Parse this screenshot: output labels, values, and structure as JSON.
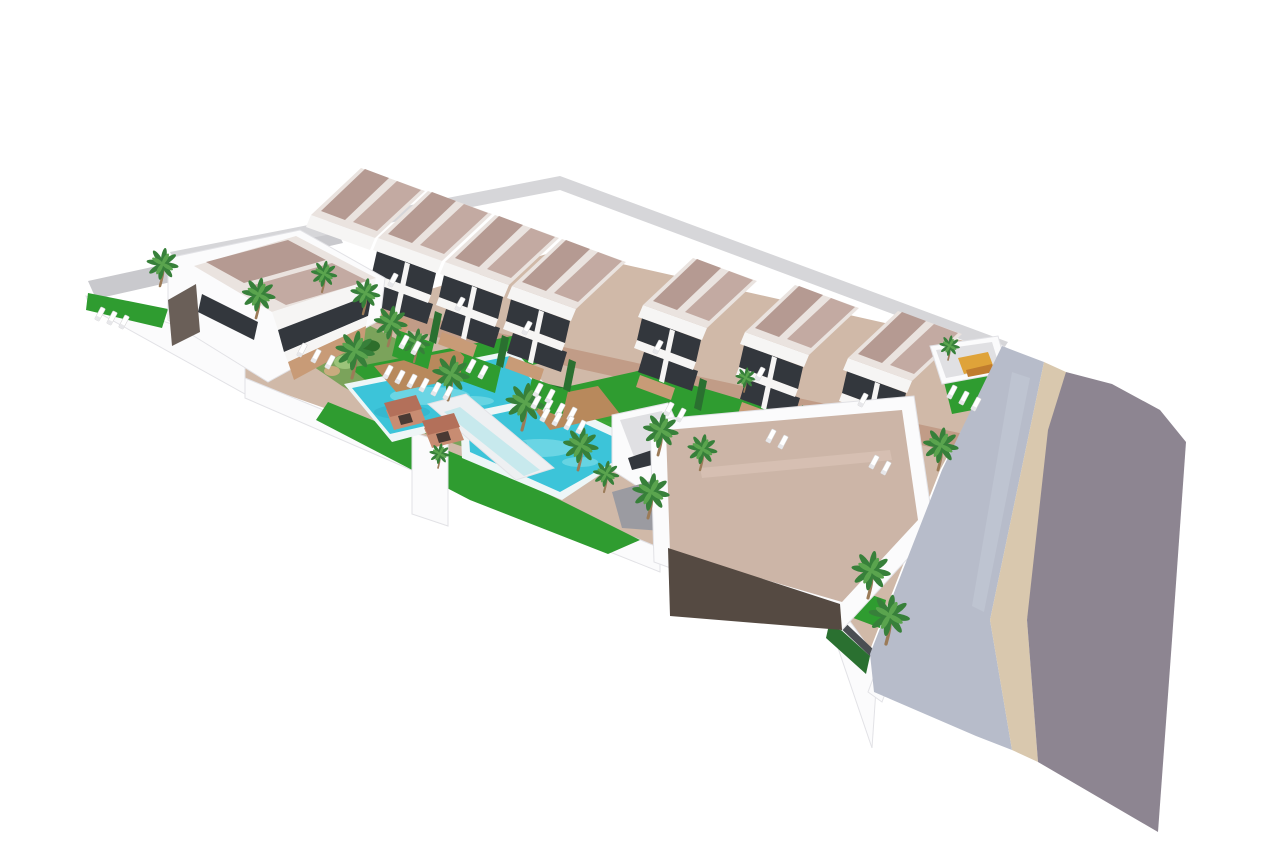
{
  "meta": {
    "description": "Aerial 3D architectural render of a white residential development: two terraces of duplex villas with mauve roofs, communal turquoise pools, lawns, palm trees, a flat-roofed clubhouse and a curving grey street with pale sidewalk on the right."
  },
  "palette": {
    "bg": "#ffffff",
    "roadLeft": "#c9c9cd",
    "padDark": "#63636a",
    "car": "#eef0f3",
    "alley": "#d6d6d9",
    "paving": "#d0b9a8",
    "brick": "#c19c87",
    "wallWhite": "#fbfbfc",
    "wallEdge": "#e2e2e6",
    "bedGreen": "#7ba35b",
    "bushDark": "#2d6e2b",
    "bushLight": "#9cc47a",
    "rock": "#c9ab7e",
    "lawn": "#2f9c30",
    "lawnLight": "#46b13c",
    "hedge": "#2a7030",
    "rim": "#eef6f7",
    "water": "#3cc4d9",
    "waterLight": "#8fe4ec",
    "waterDark": "#27a4bd",
    "bridge": "#eef0f2",
    "glassTeal": "#aee4ea",
    "wood": "#b8895c",
    "shedBody": "#c88c72",
    "shedRoof": "#b3705a",
    "shedDark": "#4a3a34",
    "white": "#f6f5f4",
    "glass": "#33373d",
    "roofTrim": "#eae3df",
    "roofPanelA": "#b59a92",
    "roofPanelB": "#c3aaa2",
    "terrace": "#c89b77",
    "sideWall": "#6a5f58",
    "beigeRoof": "#ccb5a7",
    "beigeRoofHi": "#dcc7b9",
    "darkWall": "#554a42",
    "ramp": "#9b9ba1",
    "lightRoof": "#e0e0e3",
    "orange": "#dfa339",
    "orangeDark": "#c07c2e",
    "sidewalk": "#b7bcca",
    "sidewalkHi": "#c6cbd7",
    "curb": "#d9c8ae",
    "road": "#8d8591",
    "fence": "#4a4e52",
    "trunk": "#9b7b58",
    "frond": "#37803a",
    "frondLight": "#5aa44e",
    "lounger": "#ffffff",
    "loungerBack": "#e7e7ea"
  },
  "scene": {
    "under": [
      {
        "n": "left-street",
        "f": "roadLeft",
        "p": "88,281 335,227 343,243 96,299"
      },
      {
        "n": "parking-pad",
        "f": "padDark",
        "p": "168,302 252,282 300,322 214,346"
      },
      {
        "n": "parked-car",
        "f": "car",
        "p": "188,294 206,290 212,298 194,302"
      },
      {
        "n": "parked-car",
        "f": "car",
        "p": "212,303 230,299 236,307 218,311"
      },
      {
        "n": "back-lane",
        "f": "alley",
        "p": "170,252 560,176 1008,342 1000,354 560,190 176,264"
      },
      {
        "n": "site-paving",
        "f": "paving",
        "p": "245,345 560,250 1005,350 940,470 868,655 838,625 660,552 490,500 415,440 245,380"
      },
      {
        "n": "perimeter-wall",
        "f": "wallWhite",
        "s": "wallEdge",
        "p": "86,296 245,348 245,394 90,308"
      },
      {
        "n": "left-garden-lawn",
        "f": "lawn",
        "p": "88,293 168,309 162,328 86,310"
      },
      {
        "n": "perimeter-wall",
        "f": "wallWhite",
        "s": "wallEdge",
        "p": "245,378 490,478 490,504 245,398"
      },
      {
        "n": "perimeter-wall",
        "f": "wallWhite",
        "s": "wallEdge",
        "p": "490,478 660,548 660,572 490,504"
      },
      {
        "n": "perimeter-wall",
        "f": "wallWhite",
        "s": "wallEdge",
        "p": "836,602 878,660 872,748 838,648"
      },
      {
        "n": "side-wall",
        "f": "wallWhite",
        "s": "wallEdge",
        "p": "1000,344 1012,352 882,702 868,692"
      },
      {
        "n": "promenade-path",
        "f": "brick",
        "p": "334,314 356,302 1010,444 988,460"
      },
      {
        "n": "garden-bed",
        "f": "bedGreen",
        "p": "302,336 362,322 415,348 478,390 525,422 478,452 420,432 342,386 298,356"
      },
      {
        "n": "garden-bush",
        "f": "bushDark",
        "e": [
          320,
          345,
          13,
          8
        ]
      },
      {
        "n": "garden-bush",
        "f": "bushLight",
        "e": [
          345,
          362,
          11,
          7
        ]
      },
      {
        "n": "garden-bush",
        "f": "bushDark",
        "e": [
          370,
          346,
          10,
          6
        ]
      },
      {
        "n": "garden-bush",
        "f": "bushDark",
        "e": [
          395,
          372,
          12,
          8
        ]
      },
      {
        "n": "garden-bush",
        "f": "bushLight",
        "e": [
          420,
          390,
          10,
          6
        ]
      },
      {
        "n": "garden-bush",
        "f": "bushDark",
        "e": [
          445,
          407,
          11,
          7
        ]
      },
      {
        "n": "garden-bush",
        "f": "bushLight",
        "e": [
          468,
          424,
          10,
          6
        ]
      },
      {
        "n": "garden-rock",
        "f": "rock",
        "e": [
          332,
          371,
          8,
          5
        ]
      },
      {
        "n": "garden-rock",
        "f": "rock",
        "e": [
          405,
          353,
          7,
          4
        ]
      },
      {
        "n": "garden-bush",
        "f": "bushDark",
        "e": [
          488,
          440,
          11,
          7
        ]
      },
      {
        "n": "garden-bush",
        "f": "bushLight",
        "e": [
          300,
          352,
          8,
          5
        ]
      },
      {
        "n": "garden-bush",
        "f": "bushDark",
        "e": [
          640,
          430,
          8,
          5
        ]
      },
      {
        "n": "garden-bush",
        "f": "bushDark",
        "e": [
          690,
          452,
          7,
          5
        ]
      },
      {
        "n": "pool-lawn",
        "f": "lawn",
        "p": "350,368 512,336 546,362 386,396"
      },
      {
        "n": "hedge-row",
        "f": "hedge",
        "p": "517,377 688,415 684,427 513,389"
      },
      {
        "n": "main-lawn",
        "f": "lawn",
        "p": "552,390 642,370 918,452 836,514 688,478 592,440 538,410"
      },
      {
        "n": "lawn-stripe",
        "f": "lawnLight",
        "op": 0.45,
        "p": "600,420 820,472 816,482 596,430"
      },
      {
        "n": "lawn-stripe",
        "f": "lawnLight",
        "op": 0.35,
        "p": "570,404 790,456 786,466 566,414"
      },
      {
        "n": "south-lawn",
        "f": "lawn",
        "p": "328,402 520,480 640,540 608,554 470,500 316,420"
      },
      {
        "n": "wall-pillar",
        "f": "wallWhite",
        "s": "wallEdge",
        "p": "412,432 448,444 448,526 412,514"
      },
      {
        "n": "side-lawn",
        "f": "lawn",
        "p": "852,588 886,600 880,628 848,616"
      },
      {
        "n": "side-lawn",
        "f": "lawn",
        "p": "898,632 934,646 928,668 892,654"
      },
      {
        "n": "boundary-hedge",
        "f": "hedge",
        "p": "830,620 870,656 866,674 826,638"
      },
      {
        "n": "boundary-fence",
        "f": "fence",
        "p": "834,612 874,650 872,658 832,620"
      },
      {
        "n": "pool-deck-edge",
        "f": "rim",
        "p": "344,384 514,350 558,398 392,442"
      },
      {
        "n": "swimming-pool",
        "f": "water",
        "p": "352,388 510,356 548,398 390,434"
      },
      {
        "n": "pool-ripple",
        "f": "waterLight",
        "op": 0.55,
        "e": [
          430,
          396,
          40,
          9
        ]
      },
      {
        "n": "pool-ripple",
        "f": "waterLight",
        "op": 0.5,
        "e": [
          472,
          401,
          22,
          5
        ]
      },
      {
        "n": "pool-ripple",
        "f": "waterDark",
        "op": 0.35,
        "e": [
          402,
          412,
          28,
          7
        ]
      },
      {
        "n": "pool-deck-edge",
        "f": "rim",
        "p": "460,414 546,396 646,444 562,500 462,458"
      },
      {
        "n": "swimming-pool",
        "f": "water",
        "p": "468,420 542,404 638,448 560,492 470,452"
      },
      {
        "n": "pool-ripple",
        "f": "waterLight",
        "op": 0.55,
        "e": [
          540,
          448,
          34,
          9
        ]
      },
      {
        "n": "pool-ripple",
        "f": "waterDark",
        "op": 0.3,
        "e": [
          505,
          444,
          22,
          6
        ]
      },
      {
        "n": "pool-ripple",
        "f": "waterLight",
        "op": 0.5,
        "e": [
          580,
          462,
          18,
          5
        ]
      },
      {
        "n": "pool-walkway",
        "f": "bridge",
        "s": "wallEdge",
        "p": "428,404 466,394 554,468 516,480"
      },
      {
        "n": "glass-balustrade",
        "f": "glassTeal",
        "op": 0.6,
        "p": "444,412 460,407 540,470 524,476"
      },
      {
        "n": "sun-deck",
        "f": "wood",
        "p": "374,366 458,350 480,374 396,392"
      },
      {
        "n": "sun-deck",
        "f": "wood",
        "p": "528,400 598,386 620,414 550,430"
      },
      {
        "n": "pool-shed",
        "f": "shedBody",
        "p": "386,410 418,402 426,422 394,430"
      },
      {
        "n": "pool-shed-roof",
        "f": "shedRoof",
        "p": "384,403 416,395 422,409 390,417"
      },
      {
        "n": "pool-shed-door",
        "f": "shedDark",
        "p": "398,416 410,413 413,422 401,425"
      },
      {
        "n": "pool-shed",
        "f": "shedBody",
        "p": "424,428 456,420 464,440 432,448"
      },
      {
        "n": "pool-shed-roof",
        "f": "shedRoof",
        "p": "422,421 454,413 460,427 428,435"
      },
      {
        "n": "pool-shed-door",
        "f": "shedDark",
        "p": "436,434 448,431 451,440 439,443"
      }
    ],
    "houses": [
      {
        "x": 311,
        "y": 215,
        "roofOnly": true
      },
      {
        "x": 378,
        "y": 238
      },
      {
        "x": 445,
        "y": 262
      },
      {
        "x": 512,
        "y": 286
      },
      {
        "x": 643,
        "y": 305
      },
      {
        "x": 745,
        "y": 332
      },
      {
        "x": 848,
        "y": 358
      }
    ],
    "over": [
      {
        "n": "villa-body",
        "f": "wallWhite",
        "s": "wallEdge",
        "p": "168,258 300,230 385,278 380,320 268,382 168,320"
      },
      {
        "n": "villa-roof",
        "f": "roofTrim",
        "p": "194,266 296,236 376,278 272,312"
      },
      {
        "n": "villa-roof-panel",
        "f": "roofPanelA",
        "p": "206,262 288,240 326,260 244,283"
      },
      {
        "n": "villa-roof-panel",
        "f": "roofPanelB",
        "p": "250,286 332,263 368,281 286,305"
      },
      {
        "n": "villa-fascia",
        "f": "white",
        "p": "272,312 376,278 372,294 278,330"
      },
      {
        "n": "villa-glazing",
        "f": "glass",
        "p": "278,330 372,294 368,316 284,352"
      },
      {
        "n": "villa-band",
        "f": "white",
        "p": "284,352 368,316 366,326 288,362"
      },
      {
        "n": "villa-terrace",
        "f": "terrace",
        "p": "288,362 366,326 364,342 294,380"
      },
      {
        "n": "villa-side-wall",
        "f": "sideWall",
        "p": "168,300 196,284 200,332 172,346"
      },
      {
        "n": "villa-glazing",
        "f": "glass",
        "p": "202,294 258,322 254,340 198,312"
      },
      {
        "n": "annex-body",
        "f": "wallWhite",
        "s": "wallEdge",
        "p": "612,415 668,403 690,452 640,488 612,470"
      },
      {
        "n": "annex-roof",
        "f": "lightRoof",
        "p": "620,420 662,411 680,448 636,462"
      },
      {
        "n": "annex-window",
        "f": "glass",
        "p": "628,458 652,450 656,464 632,470"
      },
      {
        "n": "driveway-ramp",
        "f": "ramp",
        "p": "612,492 662,478 676,532 622,528"
      },
      {
        "n": "clubhouse-body",
        "f": "wallWhite",
        "s": "wallEdge",
        "p": "650,420 914,396 934,530 842,630 654,562"
      },
      {
        "n": "clubhouse-roof",
        "f": "beigeRoof",
        "p": "666,430 902,410 918,520 842,602 670,552"
      },
      {
        "n": "clubhouse-roof-ridge",
        "f": "beigeRoofHi",
        "op": 0.6,
        "p": "700,468 890,450 892,460 702,478"
      },
      {
        "n": "clubhouse-wall",
        "f": "darkWall",
        "p": "668,548 840,604 842,630 670,616"
      },
      {
        "n": "corner-lawn",
        "f": "lawn",
        "p": "944,382 996,374 1004,404 952,414"
      },
      {
        "n": "garage-body",
        "f": "wallWhite",
        "s": "wallEdge",
        "p": "930,346 998,336 1008,372 942,384"
      },
      {
        "n": "garage-roof",
        "f": "lightRoof",
        "p": "936,350 992,342 1000,368 946,378"
      },
      {
        "n": "pergola",
        "f": "orange",
        "p": "958,358 988,352 994,368 964,374"
      },
      {
        "n": "pergola",
        "f": "orangeDark",
        "p": "966,370 992,364 994,372 968,377"
      },
      {
        "n": "sidewalk",
        "f": "sidewalk",
        "p": "1002,346 1044,362 990,620 1012,750 976,736 874,692 870,654 942,470"
      },
      {
        "n": "sidewalk-highlight",
        "f": "sidewalkHi",
        "op": 0.5,
        "p": "1012,372 1030,378 984,612 972,606"
      },
      {
        "n": "curb-strip",
        "f": "curb",
        "p": "1044,362 1066,372 1027,620 1038,762 1012,750 990,620"
      },
      {
        "n": "street",
        "f": "road",
        "p": "1066,372 1112,384 1160,410 1186,442 1172,640 1158,832 1038,762 1027,620 1048,430"
      }
    ],
    "palms": [
      [
        160,
        286,
        0.85
      ],
      [
        256,
        318,
        0.9
      ],
      [
        322,
        292,
        0.7
      ],
      [
        363,
        314,
        0.8
      ],
      [
        388,
        346,
        0.9
      ],
      [
        352,
        378,
        1.05
      ],
      [
        414,
        362,
        0.75
      ],
      [
        448,
        400,
        1.0
      ],
      [
        522,
        430,
        1.05
      ],
      [
        578,
        470,
        0.95
      ],
      [
        658,
        455,
        0.95
      ],
      [
        700,
        470,
        0.8
      ],
      [
        648,
        518,
        1.0
      ],
      [
        604,
        492,
        0.7
      ],
      [
        438,
        468,
        0.55
      ],
      [
        868,
        598,
        1.05
      ],
      [
        886,
        644,
        1.1
      ],
      [
        938,
        470,
        0.95
      ],
      [
        948,
        360,
        0.55
      ],
      [
        744,
        392,
        0.55
      ]
    ],
    "loungers": [
      [
        100,
        314
      ],
      [
        112,
        318
      ],
      [
        124,
        322
      ],
      [
        388,
        372
      ],
      [
        400,
        377
      ],
      [
        412,
        381
      ],
      [
        424,
        385
      ],
      [
        436,
        389
      ],
      [
        448,
        393
      ],
      [
        536,
        402
      ],
      [
        548,
        406
      ],
      [
        560,
        410
      ],
      [
        572,
        414
      ],
      [
        545,
        415
      ],
      [
        557,
        419
      ],
      [
        569,
        423
      ],
      [
        581,
        427
      ],
      [
        404,
        342
      ],
      [
        416,
        348
      ],
      [
        471,
        366
      ],
      [
        483,
        372
      ],
      [
        538,
        390
      ],
      [
        550,
        396
      ],
      [
        669,
        409
      ],
      [
        681,
        415
      ],
      [
        771,
        436
      ],
      [
        783,
        442
      ],
      [
        874,
        462
      ],
      [
        886,
        468
      ],
      [
        393,
        280
      ],
      [
        460,
        304
      ],
      [
        527,
        328
      ],
      [
        658,
        347
      ],
      [
        760,
        374
      ],
      [
        863,
        400
      ],
      [
        302,
        350
      ],
      [
        316,
        356
      ],
      [
        330,
        362
      ],
      [
        952,
        392
      ],
      [
        964,
        398
      ],
      [
        976,
        404
      ]
    ]
  }
}
